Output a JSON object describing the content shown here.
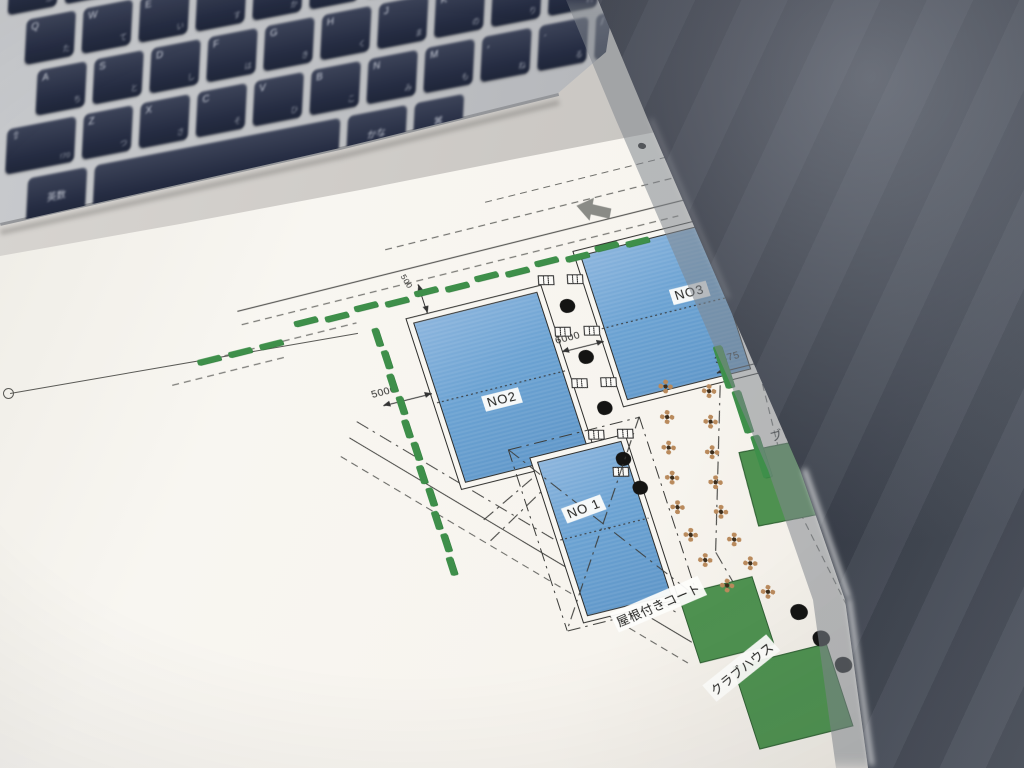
{
  "photo": {
    "plan": {
      "courts": [
        {
          "id": "no2",
          "label": "NO2"
        },
        {
          "id": "no3",
          "label": "NO3"
        },
        {
          "id": "no1",
          "label": "NO 1"
        }
      ],
      "roofed_court_label": "屋根付きコート",
      "clubhouse_label": "クラブハウス",
      "block_label": "ブロ",
      "dimensions": {
        "left": "5000",
        "walkway": "6000",
        "right": "3375",
        "top": "500"
      },
      "colors": {
        "court_blue": "#6BA2D2",
        "hedge_green": "#3E8F4A",
        "building_green": "#4E9150",
        "paper": "#F7F5F0",
        "object_dark": "#2B303B",
        "key_navy": "#2A3047"
      },
      "flowers": [
        [
          368,
          160
        ],
        [
          360,
          190
        ],
        [
          352,
          220
        ],
        [
          346,
          250
        ],
        [
          342,
          280
        ],
        [
          346,
          310
        ],
        [
          352,
          338
        ],
        [
          408,
          175
        ],
        [
          400,
          205
        ],
        [
          392,
          235
        ],
        [
          386,
          265
        ],
        [
          382,
          295
        ],
        [
          386,
          325
        ],
        [
          394,
          352
        ],
        [
          365,
          368
        ],
        [
          402,
          384
        ]
      ],
      "benches": [
        [
          286,
          30
        ],
        [
          314,
          36
        ],
        [
          286,
          84
        ],
        [
          314,
          90
        ],
        [
          286,
          138
        ],
        [
          314,
          144
        ],
        [
          286,
          192
        ],
        [
          314,
          198
        ],
        [
          298,
          234
        ]
      ],
      "walkway_trees": [
        [
          299,
          58
        ],
        [
          301,
          112
        ],
        [
          303,
          166
        ],
        [
          305,
          220
        ],
        [
          312,
          252
        ]
      ],
      "corner_trees": [
        [
          424,
          410
        ],
        [
          437,
          441
        ],
        [
          450,
          472
        ]
      ],
      "hedge_top_xs": [
        40,
        71,
        102,
        133,
        164,
        195,
        226,
        257,
        288,
        319,
        350,
        381
      ],
      "hedge_top2_xs": [
        -64,
        -32,
        0
      ],
      "hedge_left_ys": [
        40,
        64,
        88,
        112,
        136,
        160,
        184,
        208,
        232,
        256,
        280
      ],
      "right_hedges": [
        [
          432,
          140
        ],
        [
          436,
          188
        ],
        [
          440,
          236
        ]
      ]
    },
    "keyboard": {
      "rows": [
        {
          "x": 0,
          "keys": [
            "2|ふ",
            "3|あ",
            "4|う",
            "5|え",
            "6|お",
            "7|や",
            "8|ゆ",
            "9|よ",
            "0|わ",
            "-|ほ",
            "^|へ",
            "¥|ー"
          ]
        },
        {
          "x": 20,
          "keys": [
            "Q|た",
            "W|て",
            "E|い",
            "R|す",
            "T|か",
            "Y|ん",
            "U|な",
            "I|に",
            "O|ら",
            "P|せ",
            "@|゛",
            "[|゜"
          ]
        },
        {
          "x": 34,
          "keys": [
            "A|ち",
            "S|と",
            "D|し",
            "F|は",
            "G|き",
            "H|く",
            "J|ま",
            "K|の",
            "L|り",
            ";|れ",
            ":|け",
            "]|む"
          ]
        },
        {
          "x": 6,
          "keys": [
            "⇧|!70",
            "Z|つ",
            "X|さ",
            "C|そ",
            "V|ひ",
            "B|こ",
            "N|み",
            "M|も",
            ",|ね",
            ".|る",
            "/|め"
          ]
        },
        {
          "x": 30,
          "keys": [
            "英数|!60c",
            "␣|!250s",
            "かな|!60c",
            "⌘|!50c"
          ]
        }
      ]
    }
  }
}
